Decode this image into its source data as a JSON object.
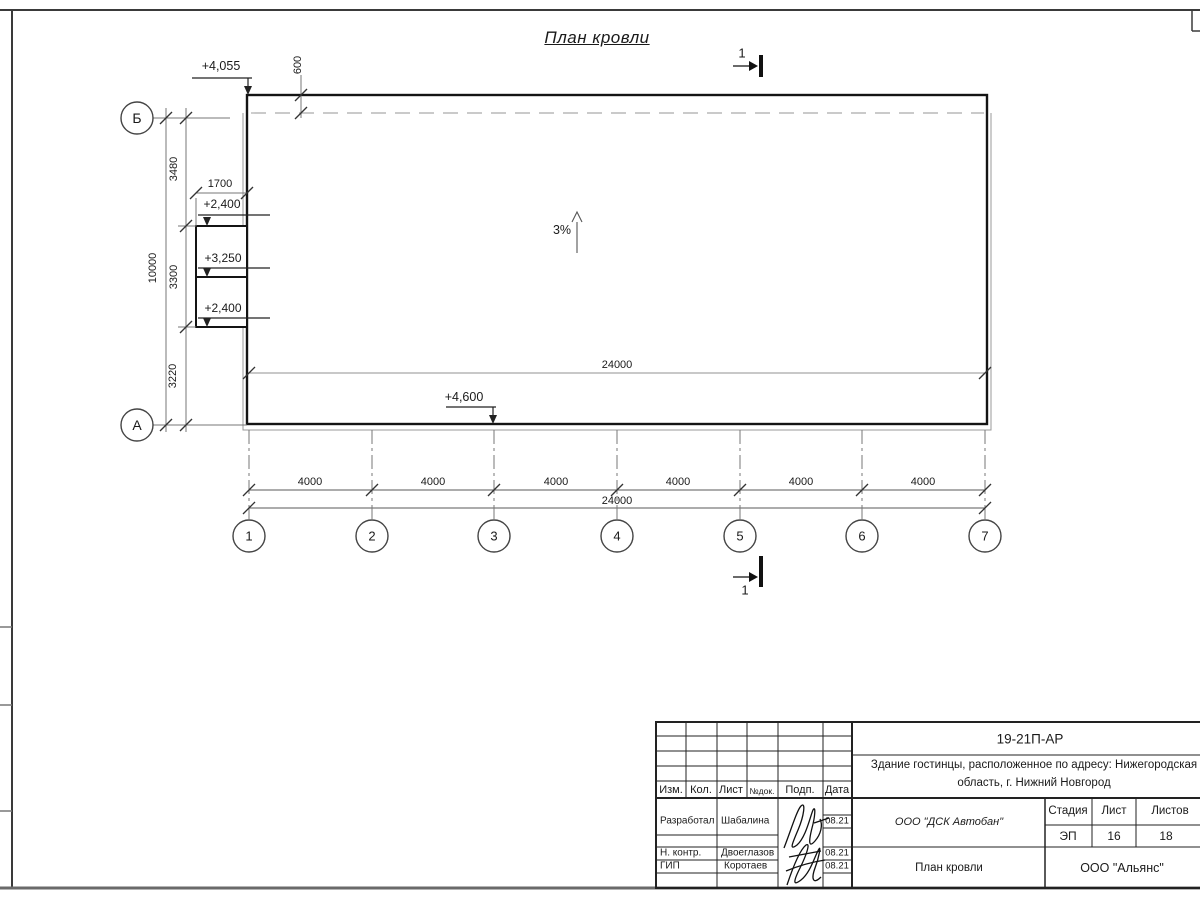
{
  "drawing": {
    "title": "План кровли",
    "slope_label": "3%",
    "section_label": "1",
    "elevations": {
      "roof_corner": "+4,055",
      "canopy_top": "+2,400",
      "canopy_mid": "+3,250",
      "canopy_bottom": "+2,400",
      "entry": "+4,600"
    },
    "dims": {
      "overhang": "600",
      "canopy_width": "1700",
      "row_b_seg": "3480",
      "canopy_seg": "3300",
      "row_a_seg": "3220",
      "total_depth": "10000",
      "inner_length": "24000",
      "total_length": "24000",
      "bays": [
        "4000",
        "4000",
        "4000",
        "4000",
        "4000",
        "4000"
      ]
    },
    "axes": {
      "rows": [
        "Б",
        "А"
      ],
      "cols": [
        "1",
        "2",
        "3",
        "4",
        "5",
        "6",
        "7"
      ]
    }
  },
  "titleblock": {
    "doc_code": "19-21П-АР",
    "object_line1": "Здание гостинцы, расположенное по адресу: Нижегородская",
    "object_line2": "область, г. Нижний Новгород",
    "columns": {
      "izm": "Изм.",
      "kol": "Кол.",
      "list": "Лист",
      "ndok": "№док.",
      "podp": "Подп.",
      "data": "Дата"
    },
    "rows": [
      {
        "role": "Разработал",
        "name": "Шабалина",
        "date": "08.21"
      },
      {
        "role": "Н. контр.",
        "name": "Двоеглазов",
        "date": "08.21"
      },
      {
        "role": "ГИП",
        "name": "Коротаев",
        "date": "08.21"
      }
    ],
    "contractor": "ООО \"ДСК Автобан\"",
    "stage_label": "Стадия",
    "sheet_label": "Лист",
    "sheets_label": "Листов",
    "stage": "ЭП",
    "sheet": "16",
    "sheets": "18",
    "sheet_title": "План кровли",
    "company": "ООО \"Альянс\""
  }
}
